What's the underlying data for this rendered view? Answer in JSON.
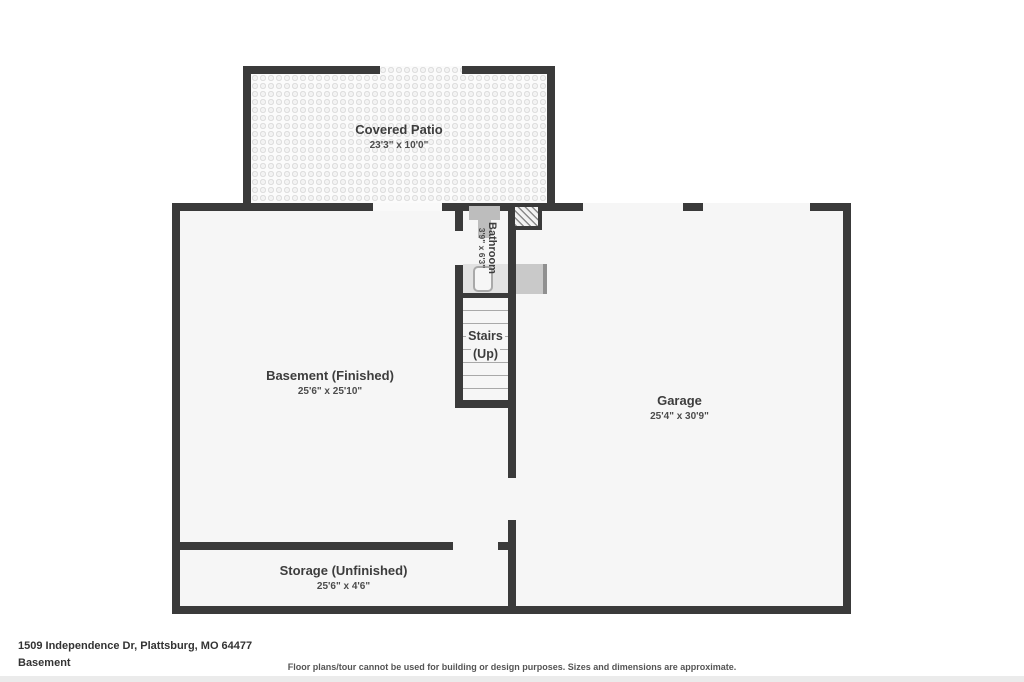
{
  "floor_plan": {
    "rooms": {
      "covered_patio": {
        "label": "Covered Patio",
        "dims": "23'3\" x 10'0\""
      },
      "bathroom": {
        "label": "Bathroom",
        "dims": "3'9\" x 6'3\""
      },
      "stairs": {
        "label": "Stairs",
        "sub": "(Up)"
      },
      "basement": {
        "label": "Basement (Finished)",
        "dims": "25'6\" x 25'10\""
      },
      "garage": {
        "label": "Garage",
        "dims": "25'4\" x 30'9\""
      },
      "storage": {
        "label": "Storage (Unfinished)",
        "dims": "25'6\" x 4'6\""
      }
    },
    "fixtures": [
      "sink",
      "toilet",
      "shower",
      "water-heater",
      "chimney"
    ],
    "colors": {
      "wall": "#3a3a3a",
      "room_fill": "#f6f6f6",
      "patio_dot": "#dfdfdf",
      "fixture_gray": "#bdbdbd",
      "background": "#ffffff"
    }
  },
  "footer": {
    "address": "1509 Independence Dr, Plattsburg, MO 64477",
    "level": "Basement",
    "disclaimer": "Floor plans/tour cannot be used for building or design purposes. Sizes and dimensions are approximate."
  }
}
